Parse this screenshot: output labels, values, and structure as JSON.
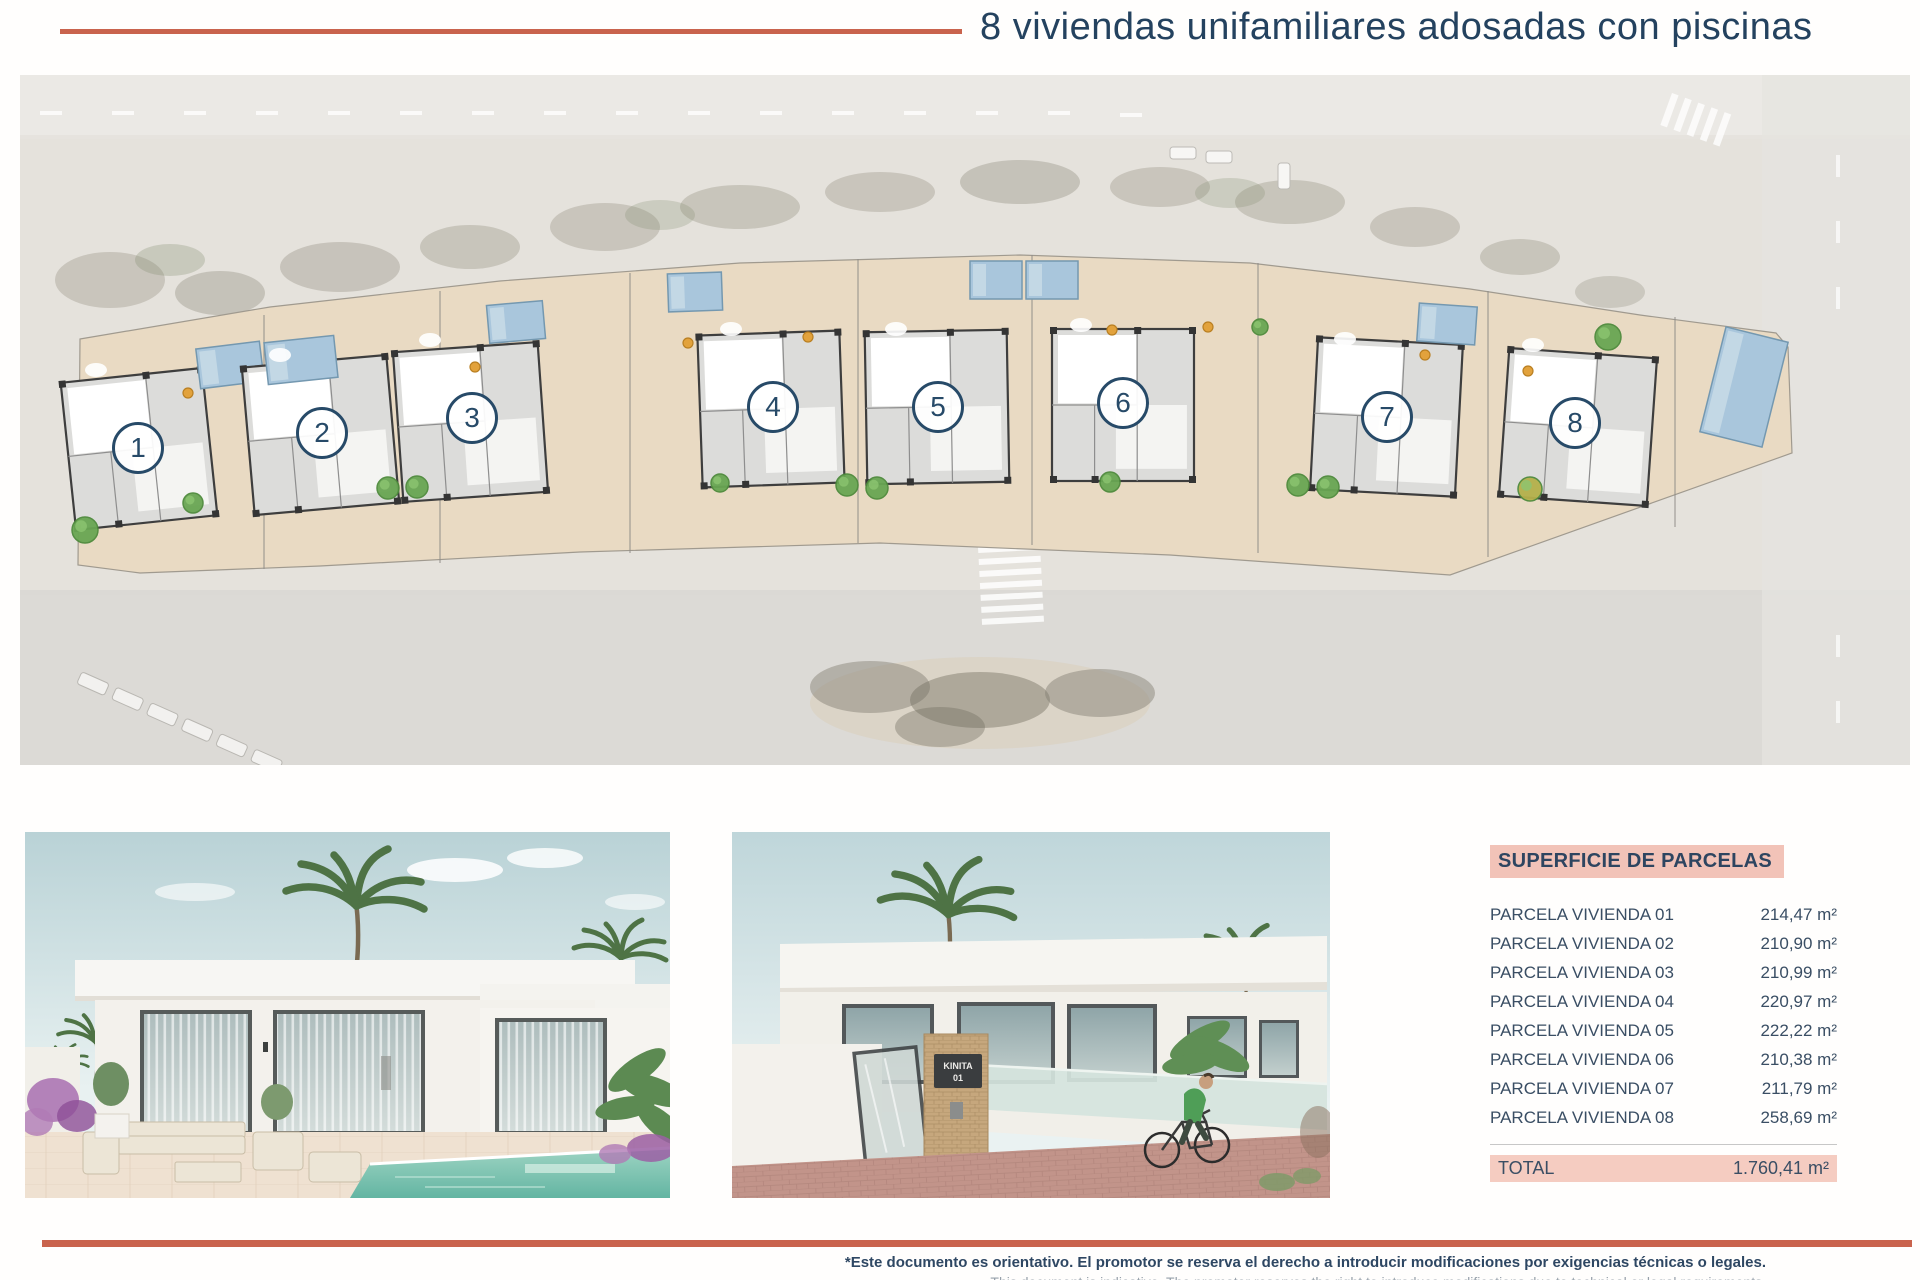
{
  "header": {
    "title": "8 viviendas unifamiliares adosadas con piscinas",
    "accent_color": "#c9634d",
    "title_color": "#24425f"
  },
  "site_plan": {
    "units": [
      {
        "number": "1",
        "cx": 118,
        "cy": 373,
        "plan": {
          "x": 48,
          "y": 300,
          "w": 142,
          "h": 148,
          "rot": -6
        },
        "pool": {
          "x": 178,
          "y": 270,
          "w": 64,
          "h": 40,
          "rot": -7
        }
      },
      {
        "number": "2",
        "cx": 302,
        "cy": 358,
        "plan": {
          "x": 228,
          "y": 286,
          "w": 145,
          "h": 148,
          "rot": -5
        },
        "pool": {
          "x": 246,
          "y": 264,
          "w": 70,
          "h": 42,
          "rot": -6
        }
      },
      {
        "number": "3",
        "cx": 452,
        "cy": 343,
        "plan": {
          "x": 378,
          "y": 272,
          "w": 145,
          "h": 150,
          "rot": -4
        },
        "pool": {
          "x": 468,
          "y": 228,
          "w": 56,
          "h": 38,
          "rot": -5
        }
      },
      {
        "number": "4",
        "cx": 753,
        "cy": 332,
        "plan": {
          "x": 680,
          "y": 258,
          "w": 142,
          "h": 152,
          "rot": -2
        },
        "pool": {
          "x": 648,
          "y": 198,
          "w": 54,
          "h": 38,
          "rot": -2
        }
      },
      {
        "number": "5",
        "cx": 918,
        "cy": 332,
        "plan": {
          "x": 846,
          "y": 256,
          "w": 142,
          "h": 152,
          "rot": -1
        },
        "pool": {
          "x": 950,
          "y": 186,
          "w": 52,
          "h": 38,
          "rot": 0
        }
      },
      {
        "number": "6",
        "cx": 1103,
        "cy": 328,
        "plan": {
          "x": 1032,
          "y": 254,
          "w": 142,
          "h": 152,
          "rot": 0
        },
        "pool": {
          "x": 1006,
          "y": 186,
          "w": 52,
          "h": 38,
          "rot": 0
        }
      },
      {
        "number": "7",
        "cx": 1367,
        "cy": 342,
        "plan": {
          "x": 1294,
          "y": 266,
          "w": 145,
          "h": 152,
          "rot": 3
        },
        "pool": {
          "x": 1398,
          "y": 230,
          "w": 58,
          "h": 38,
          "rot": 4
        }
      },
      {
        "number": "8",
        "cx": 1555,
        "cy": 348,
        "plan": {
          "x": 1484,
          "y": 278,
          "w": 148,
          "h": 148,
          "rot": 4
        },
        "pool": {
          "x": 1692,
          "y": 258,
          "w": 64,
          "h": 108,
          "rot": 14
        }
      }
    ],
    "dividers": [
      [
        244,
        240,
        494
      ],
      [
        420,
        216,
        488
      ],
      [
        610,
        198,
        478
      ],
      [
        838,
        184,
        468
      ],
      [
        1012,
        180,
        470
      ],
      [
        1238,
        188,
        478
      ],
      [
        1468,
        216,
        482
      ],
      [
        1655,
        242,
        452
      ]
    ],
    "trees": [
      {
        "x": 65,
        "y": 455,
        "r": 13,
        "c": "#69a653"
      },
      {
        "x": 173,
        "y": 428,
        "r": 10,
        "c": "#69a653"
      },
      {
        "x": 368,
        "y": 413,
        "r": 11,
        "c": "#69a653"
      },
      {
        "x": 397,
        "y": 412,
        "r": 11,
        "c": "#69a653"
      },
      {
        "x": 700,
        "y": 408,
        "r": 9,
        "c": "#69a653"
      },
      {
        "x": 827,
        "y": 410,
        "r": 11,
        "c": "#69a653"
      },
      {
        "x": 857,
        "y": 413,
        "r": 11,
        "c": "#69a653"
      },
      {
        "x": 1090,
        "y": 407,
        "r": 10,
        "c": "#69a653"
      },
      {
        "x": 1278,
        "y": 410,
        "r": 11,
        "c": "#69a653"
      },
      {
        "x": 1308,
        "y": 412,
        "r": 11,
        "c": "#69a653"
      },
      {
        "x": 1510,
        "y": 414,
        "r": 12,
        "c": "#b5b04a"
      },
      {
        "x": 1588,
        "y": 262,
        "r": 13,
        "c": "#69a653"
      },
      {
        "x": 1240,
        "y": 252,
        "r": 8,
        "c": "#69a653"
      }
    ],
    "dots": [
      {
        "x": 168,
        "y": 318
      },
      {
        "x": 455,
        "y": 292
      },
      {
        "x": 668,
        "y": 268
      },
      {
        "x": 788,
        "y": 262
      },
      {
        "x": 1092,
        "y": 255
      },
      {
        "x": 1188,
        "y": 252
      },
      {
        "x": 1405,
        "y": 280
      },
      {
        "x": 1508,
        "y": 296
      }
    ],
    "pool_color": "#a9c6dc",
    "band_color": "#e9dac3"
  },
  "photos": {
    "street": {
      "gate_sign_line1": "KINITA",
      "gate_sign_line2": "01"
    }
  },
  "parcels": {
    "header": "SUPERFICIE DE PARCELAS",
    "rows": [
      {
        "label": "PARCELA VIVIENDA 01",
        "value": "214,47 m²"
      },
      {
        "label": "PARCELA VIVIENDA 02",
        "value": "210,90 m²"
      },
      {
        "label": "PARCELA VIVIENDA 03",
        "value": "210,99 m²"
      },
      {
        "label": "PARCELA VIVIENDA 04",
        "value": "220,97 m²"
      },
      {
        "label": "PARCELA VIVIENDA 05",
        "value": "222,22 m²"
      },
      {
        "label": "PARCELA VIVIENDA 06",
        "value": "210,38 m²"
      },
      {
        "label": "PARCELA VIVIENDA 07",
        "value": "211,79 m²"
      },
      {
        "label": "PARCELA VIVIENDA 08",
        "value": "258,69 m²"
      }
    ],
    "total_label": "TOTAL",
    "total_value": "1.760,41 m²",
    "highlight_color": "#f2c3b8"
  },
  "footer": {
    "disclaimer_es": "*Este documento es orientativo. El promotor se reserva el derecho a introducir modificaciones por exigencias técnicas o legales.",
    "disclaimer_en": "This document is indicative. The promoter reserves the right to introduce modifications due to technical or legal requirements."
  }
}
